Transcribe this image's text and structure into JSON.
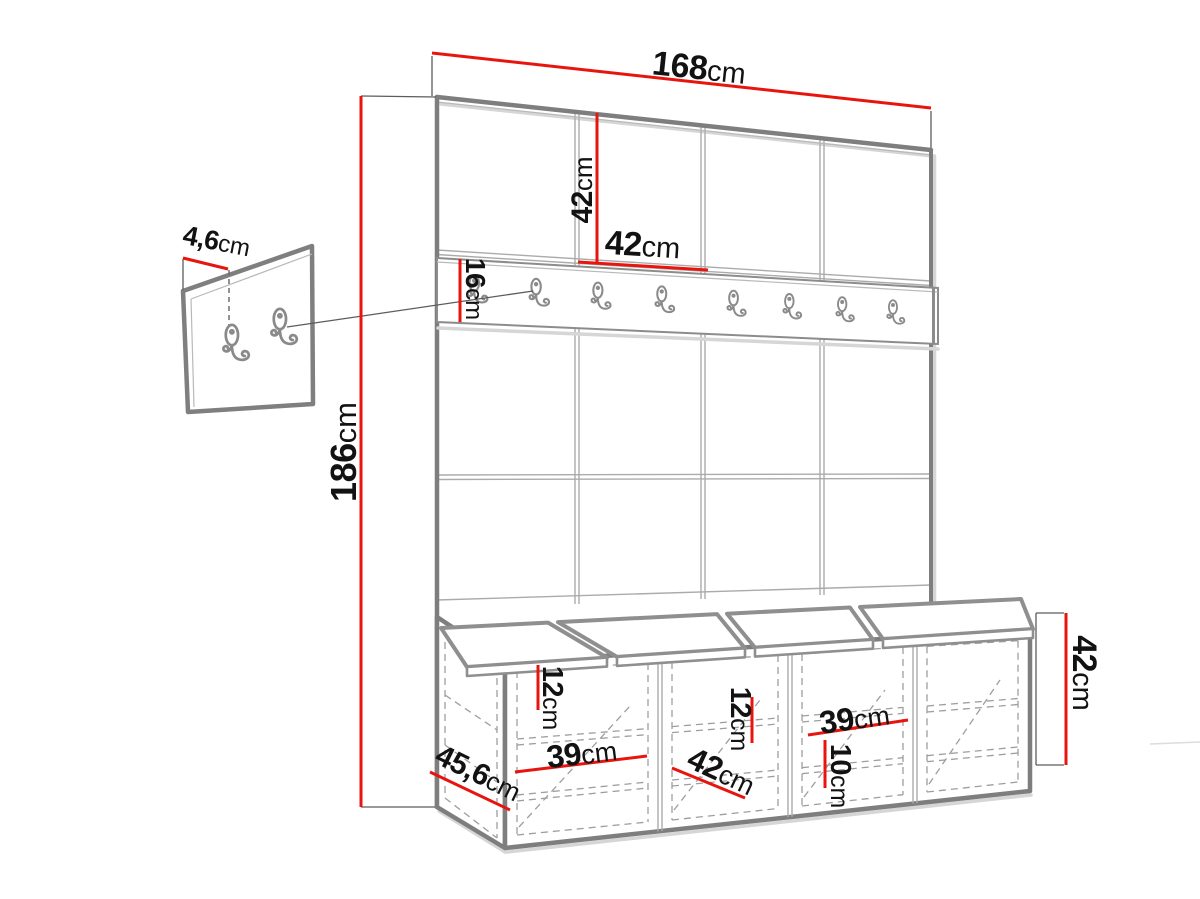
{
  "colors": {
    "dimension_red": "#e8150f",
    "outline_gray": "#7e7e7e",
    "text_color": "#121212"
  },
  "dimensions": {
    "total_width": {
      "v": "168",
      "u": "cm"
    },
    "top_panel_height": {
      "v": "42",
      "u": "cm"
    },
    "top_panel_width": {
      "v": "42",
      "u": "cm"
    },
    "rail_height": {
      "v": "16",
      "u": "cm"
    },
    "wall_panel_thickness": {
      "v": "4,6",
      "u": "cm"
    },
    "total_height": {
      "v": "186",
      "u": "cm"
    },
    "bench_depth": {
      "v": "45,6",
      "u": "cm"
    },
    "left_shelf_drop": {
      "v": "12",
      "u": "cm"
    },
    "left_shelf_width": {
      "v": "39",
      "u": "cm"
    },
    "mid_section_width": {
      "v": "42",
      "u": "cm"
    },
    "mid_shelf_drop": {
      "v": "12",
      "u": "cm"
    },
    "right_shelf_width": {
      "v": "39",
      "u": "cm"
    },
    "right_shelf_drop": {
      "v": "10",
      "u": "cm"
    },
    "bench_height": {
      "v": "42",
      "u": "cm"
    }
  },
  "icons": {
    "rail_hook": "double-coat-hook-icon",
    "panel_hook": "double-coat-hook-icon"
  },
  "hook_rail": {
    "hook_count": 8
  },
  "small_wall_panel": {
    "hook_count": 2
  }
}
